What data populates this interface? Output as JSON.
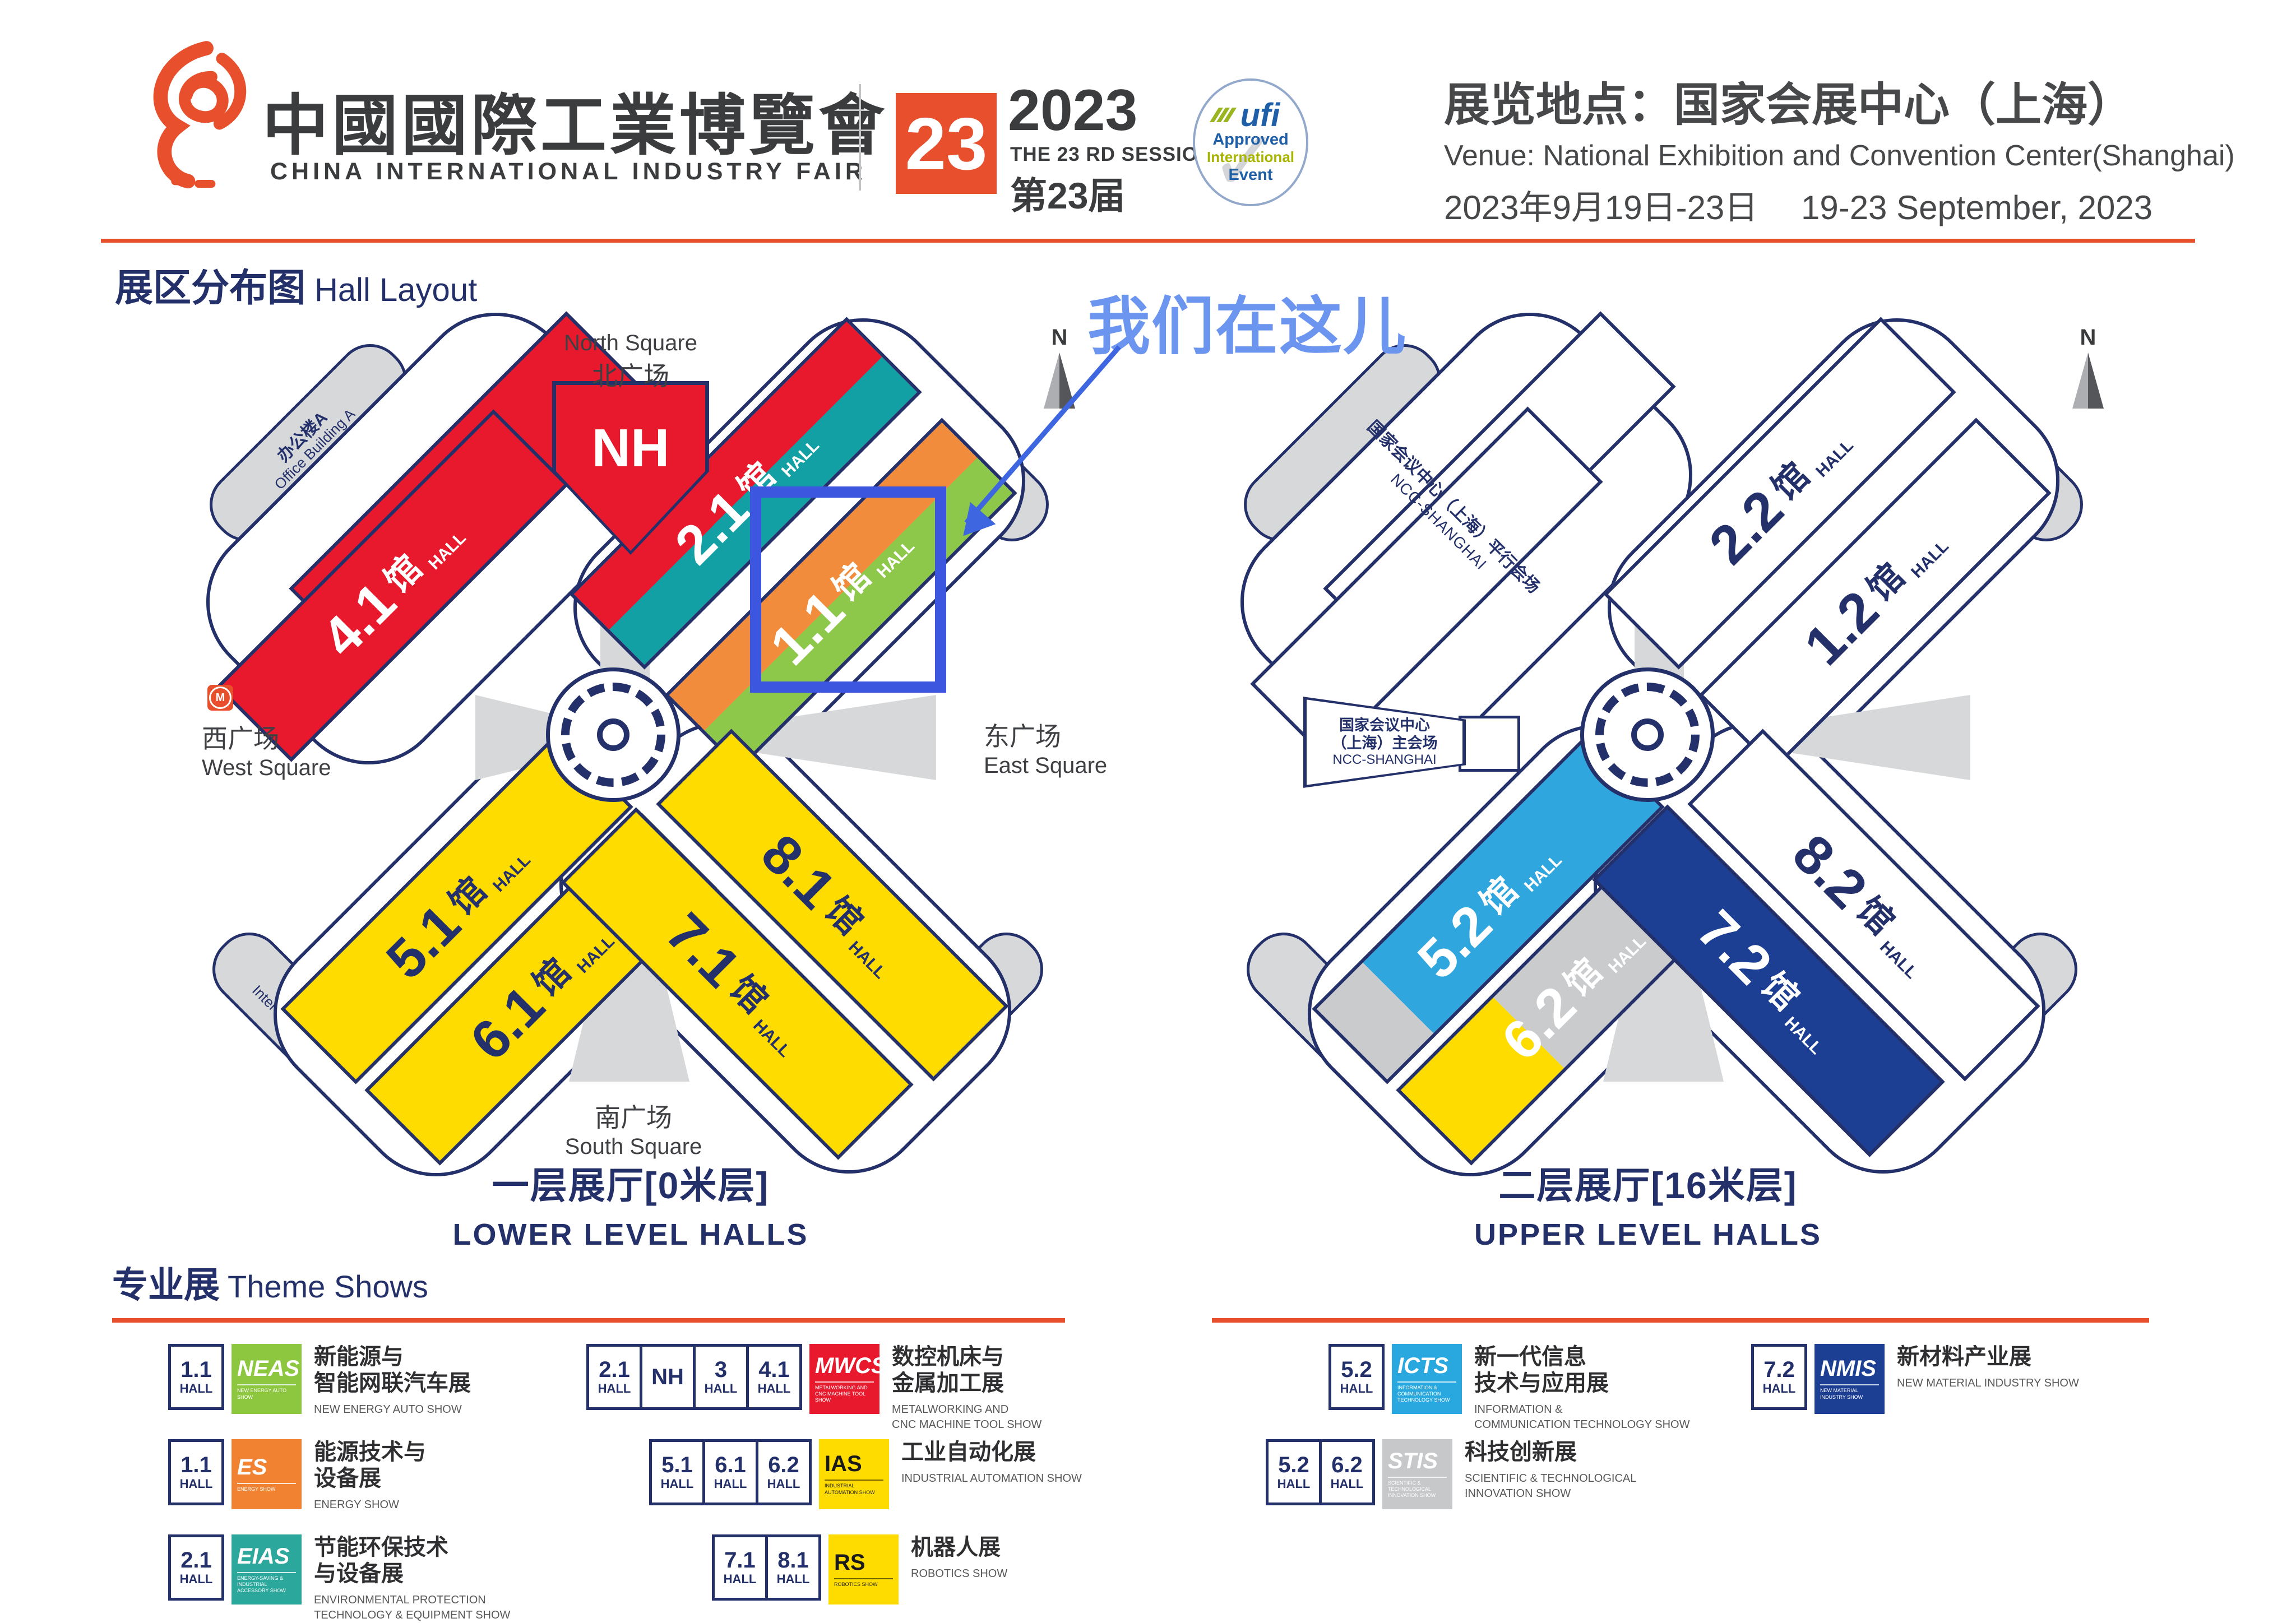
{
  "words": {
    "hall": "HALL",
    "guan": "馆",
    "compass_n": "N"
  },
  "header": {
    "brand_cn": "中國國際工業博覽會",
    "brand_en": "CHINA INTERNATIONAL INDUSTRY FAIR",
    "badge": "23",
    "year": "2023",
    "session_en": "THE 23 RD SESSION",
    "session_cn": "第23届",
    "ufi": {
      "brand": "ufi",
      "line1": "Approved",
      "line2": "International",
      "line3": "Event"
    },
    "venue_cn": "展览地点：国家会展中心（上海）",
    "venue_en": "Venue:  National Exhibition and Convention Center(Shanghai)",
    "dates": "2023年9月19日-23日　 19-23 September, 2023",
    "accent_color": "#E8502D"
  },
  "section": {
    "title_cn": "展区分布图",
    "title_en": "Hall Layout"
  },
  "annotation": {
    "here_text": "我们在这儿",
    "text_color": "#6C95F0",
    "arrow_color": "#3E66E0",
    "highlight_color": "#3D56E0"
  },
  "lower_map": {
    "north_en": "North Square",
    "north_cn": "北广场",
    "west_cn": "西广场",
    "west_en": "West Square",
    "east_cn": "东广场",
    "east_en": "East Square",
    "south_cn": "南广场",
    "south_en": "South Square",
    "office_a_cn": "办公楼A",
    "office_a_en": "Office Building A",
    "office_b_cn": "办公楼B",
    "office_b_en": "Office Building B",
    "office_c_cn": "办公楼C",
    "office_c_en": "Office Building C",
    "hotel_cn": "洲际酒店",
    "hotel_en": "InterContinental Hotel",
    "nh": "NH",
    "halls": {
      "h3": "3",
      "h41": "4.1",
      "h21": "2.1",
      "h11": "1.1",
      "h51": "5.1",
      "h61": "6.1",
      "h71": "7.1",
      "h81": "8.1"
    },
    "hall_colors": {
      "mwcs_red": "#E8192C",
      "eias_teal": "#12A0A4",
      "es_orange": "#F08C3C",
      "neas_green": "#8DC84B",
      "ias_yellow": "#FFDC00"
    },
    "caption_cn": "一层展厅[0米层]",
    "caption_en": "LOWER LEVEL HALLS"
  },
  "upper_map": {
    "halls": {
      "h22": "2.2",
      "h12": "1.2",
      "h52": "5.2",
      "h62": "6.2",
      "h72": "7.2",
      "h82": "8.2"
    },
    "hall_colors": {
      "icts_blue": "#2FA6DE",
      "stis_gray": "#C9CBCD",
      "nmis_navy": "#1C3F94",
      "ias_yellow": "#FFDC00"
    },
    "ncc_parallel_cn": "国家会议中心（上海）平行会场",
    "ncc_parallel_en": "NCC-SHANGHAI",
    "ncc_main_cn1": "国家会议中心",
    "ncc_main_cn2": "（上海）主会场",
    "ncc_main_en": "NCC-SHANGHAI",
    "c0_cn": "C0会议室（3楼）",
    "c0_en": "C0 Meeting Room",
    "caption_cn": "二层展厅[16米层]",
    "caption_en": "UPPER LEVEL HALLS"
  },
  "legend": {
    "heading_cn": "专业展",
    "heading_en": "Theme Shows",
    "entries": [
      {
        "halls": [
          "1.1"
        ],
        "abbr": "NEAS",
        "sub": "NEW ENERGY AUTO SHOW",
        "color": "#8DC63F",
        "title": [
          "新能源与",
          "智能网联汽车展"
        ],
        "caption": [
          "NEW ENERGY AUTO SHOW"
        ]
      },
      {
        "halls": [
          "1.1"
        ],
        "abbr": "ES",
        "sub": "ENERGY SHOW",
        "color": "#F08232",
        "title": [
          "能源技术与",
          "设备展"
        ],
        "caption": [
          "ENERGY SHOW"
        ]
      },
      {
        "halls": [
          "2.1"
        ],
        "abbr": "EIAS",
        "sub": "ENERGY-SAVING & INDUSTRIAL ACCESSORY SHOW",
        "color": "#2BA79C",
        "title": [
          "节能环保技术",
          "与设备展"
        ],
        "caption": [
          "ENVIRONMENTAL PROTECTION",
          "TECHNOLOGY & EQUIPMENT SHOW"
        ]
      },
      {
        "halls": [
          "2.1",
          "NH",
          "3",
          "4.1"
        ],
        "abbr": "MWCS",
        "sub": "METALWORKING AND CNC MACHINE TOOL SHOW",
        "color": "#E8192C",
        "title": [
          "数控机床与",
          "金属加工展"
        ],
        "caption": [
          "METALWORKING AND",
          "CNC MACHINE TOOL SHOW"
        ]
      },
      {
        "halls": [
          "5.1",
          "6.1",
          "6.2"
        ],
        "abbr": "IAS",
        "sub": "INDUSTRIAL AUTOMATION SHOW",
        "color": "#FFDC00",
        "title": [
          "工业自动化展"
        ],
        "caption": [
          "INDUSTRIAL AUTOMATION SHOW"
        ]
      },
      {
        "halls": [
          "7.1",
          "8.1"
        ],
        "abbr": "RS",
        "sub": "ROBOTICS SHOW",
        "color": "#FFDC00",
        "title": [
          "机器人展"
        ],
        "caption": [
          "ROBOTICS SHOW"
        ]
      },
      {
        "halls": [
          "5.2"
        ],
        "abbr": "ICTS",
        "sub": "INFORMATION & COMMUNICATION TECHNOLOGY SHOW",
        "color": "#29A8E0",
        "title": [
          "新一代信息",
          "技术与应用展"
        ],
        "caption": [
          "INFORMATION &",
          "COMMUNICATION TECHNOLOGY SHOW"
        ]
      },
      {
        "halls": [
          "5.2",
          "6.2"
        ],
        "abbr": "STIS",
        "sub": "SCIENTIFIC & TECHNOLOGICAL INNOVATION SHOW",
        "color": "#C7C8CA",
        "title": [
          "科技创新展"
        ],
        "caption": [
          "SCIENTIFIC & TECHNOLOGICAL",
          "INNOVATION SHOW"
        ]
      },
      {
        "halls": [
          "7.2"
        ],
        "abbr": "NMIS",
        "sub": "NEW MATERIAL INDUSTRY SHOW",
        "color": "#1C3F94",
        "title": [
          "新材料产业展"
        ],
        "caption": [
          "NEW MATERIAL INDUSTRY SHOW"
        ]
      }
    ]
  }
}
